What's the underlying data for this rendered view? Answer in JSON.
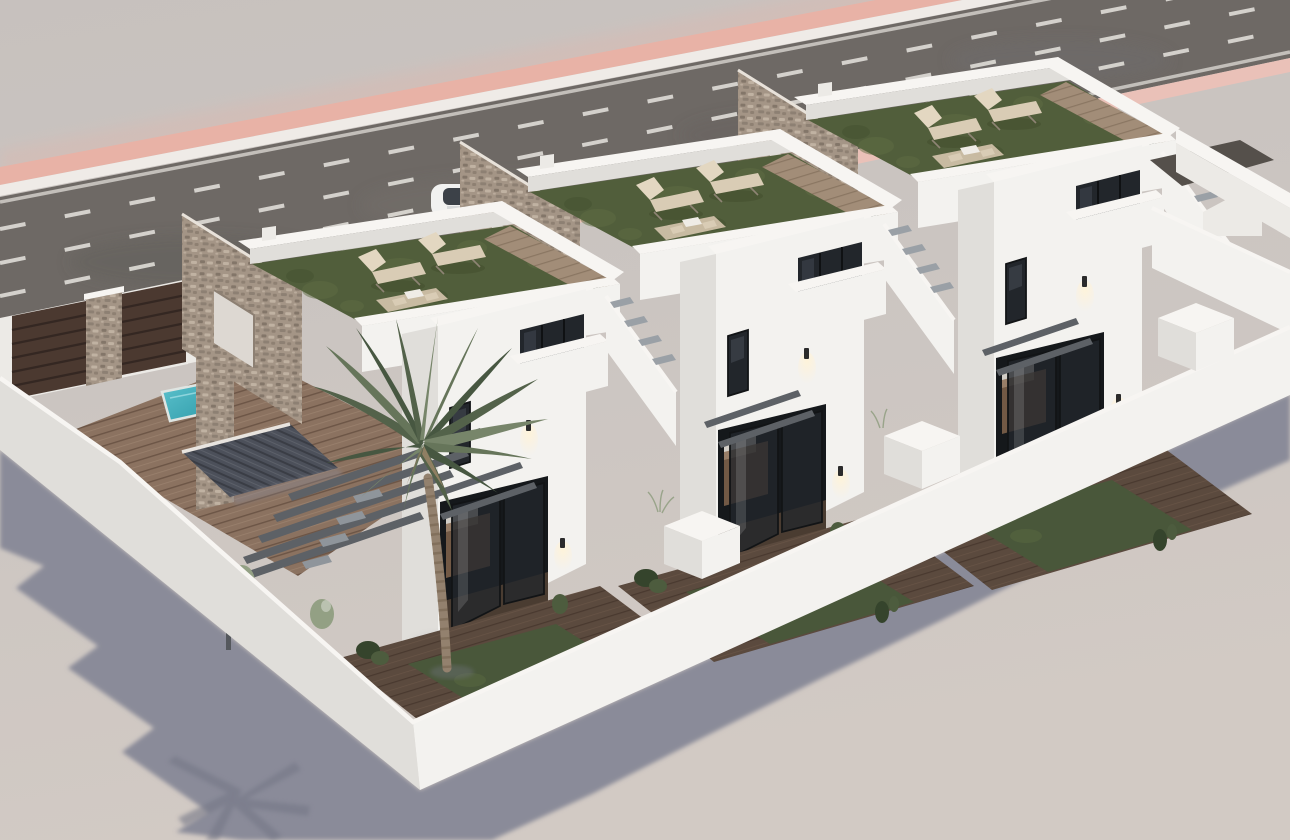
{
  "scene": {
    "type": "3d-architectural-render",
    "description": "Aerial oblique 3D rendering of a row of three identical white two-storey townhouses with rooftop solarium terraces of artificial grass, tall stone feature walls, front courtyards behind a white perimeter wall, a palm tree, a small plunge pool, a wood deck, pergola and exterior stairs, next to a wide asphalt road with pink kerb strips.",
    "view": "aerial-oblique from south-west",
    "lighting": "daylight, sun from upper right, long blue-grey shadow cast to lower left",
    "road_position": "diagonal band across the top",
    "counts": {
      "houses": 3,
      "roof_terraces": 3,
      "sun_loungers": 6,
      "roof_table_sets": 3,
      "stone_feature_walls": 3,
      "wall_lamps": 6,
      "planter_boxes": 3,
      "palm_trees": 1,
      "pools": 1,
      "parked_cars": 1,
      "driveway_gate_panels": 2,
      "road_dashed_lane_lines": 3
    },
    "objects": [
      "asphalt road",
      "pink kerb strips",
      "white lane markings",
      "parked white car",
      "three white townhouses",
      "rooftop terraces with artificial grass",
      "sun loungers",
      "stone feature walls",
      "glass sliding doors",
      "balconies",
      "wall lamps",
      "front courtyards",
      "white perimeter wall",
      "planter boxes",
      "driveway gates",
      "palm tree",
      "plunge pool",
      "wood deck",
      "pergola beams",
      "exterior stair",
      "tiled porch roof",
      "cast shadow with palm silhouette"
    ]
  },
  "colors": {
    "ground_top": "#c7c1be",
    "ground_mid": "#cbc5c1",
    "ground_bottom": "#d2cac4",
    "road": "#6e6965",
    "road_dark": "#5d5955",
    "road_light": "#7b7672",
    "road_blue": "#6b6c74",
    "lane_line": "#e7e4df",
    "curb_pink_far": "#e8b2a6",
    "curb_pink_near": "#eac1b8",
    "curb_white": "#efebe7",
    "shadow": "#8a8b99",
    "shadow_dark": "#757786",
    "wall_bright": "#f3f2ef",
    "wall_light": "#eceae6",
    "wall_shaded": "#e0deda",
    "wall_dark": "#cfcdcb",
    "coping": "#f7f5f2",
    "stone_base": "#a49586",
    "stone_dark": "#7e7164",
    "stone_light": "#c3b5a5",
    "grass_roof": "#515e3b",
    "grass_light": "#5f6d44",
    "grass_dark": "#434f2e",
    "grass_yard": "#49573a",
    "lounger": "#d9ccb5",
    "lounger_frame": "#8e8474",
    "wood_deck": "#8b7260",
    "wood_deck_dark": "#6c5546",
    "wood_roofdeck": "#a28d78",
    "tile_roof": "#4c505a",
    "tile_roof_dark": "#3a3d45",
    "beam": "#5d6166",
    "glass": "#22262b",
    "glass_reflect": "#49505a",
    "frame_dark": "#121416",
    "pool": "#45b4c1",
    "pool_deep": "#2e9aa8",
    "gate_brown": "#4b3930",
    "gate_dark": "#342722",
    "interior_warm": "#8a6a50",
    "cabinet_light": "#e7e2da",
    "lamp_glow": "#fff3d8",
    "car_body": "#f1f1f0",
    "car_glass": "#3c4148",
    "plant_dark": "#35442c",
    "plant_mid": "#4d5c3e",
    "plant_sage": "#93a084",
    "palm_1": "#66755a",
    "palm_2": "#53624a",
    "palm_3": "#77856a",
    "palm_4": "#475741",
    "palm_trunk": "#93816e"
  }
}
